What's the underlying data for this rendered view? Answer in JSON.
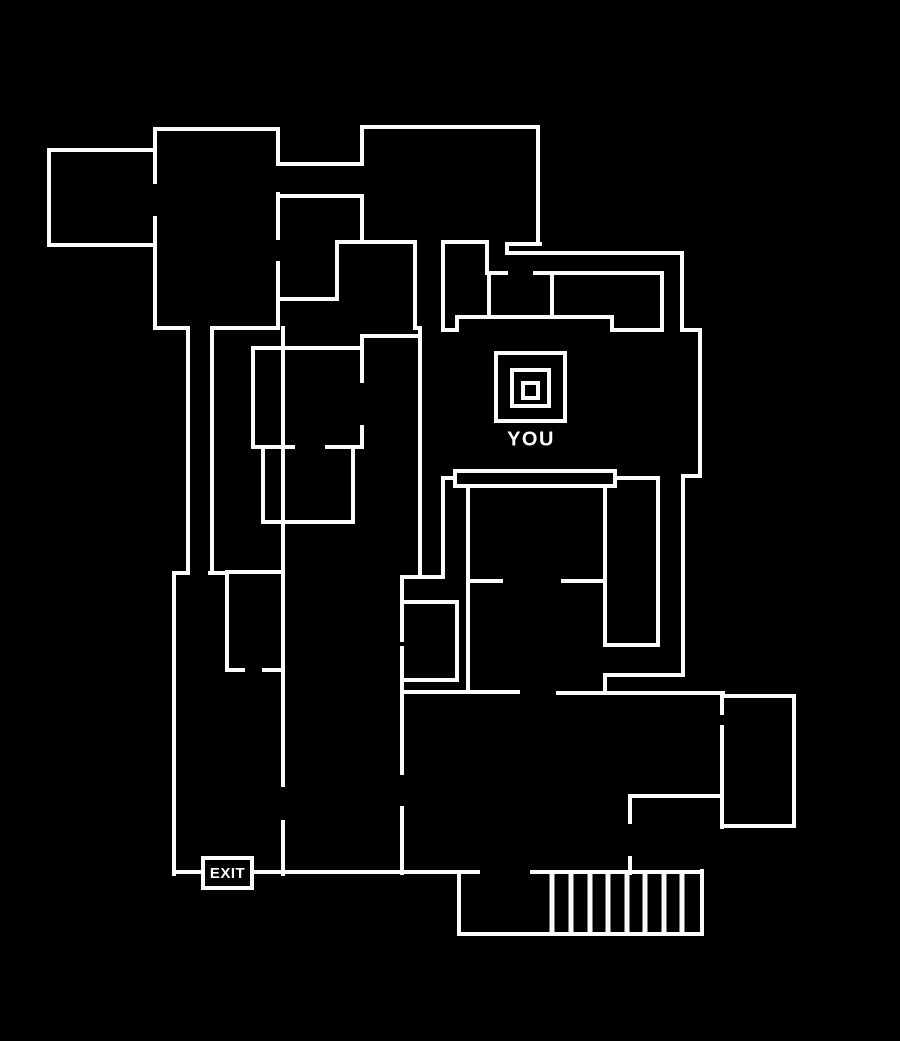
{
  "canvas": {
    "width": 900,
    "height": 1041,
    "background_color": "#000000",
    "wall_color": "#fbfbfb",
    "wall_width": 4
  },
  "you": {
    "label": "YOU"
  },
  "exit": {
    "label": "EXIT"
  },
  "map": {
    "walls": [
      [
        49,
        150,
        154,
        150
      ],
      [
        49,
        150,
        49,
        245
      ],
      [
        49,
        245,
        154,
        245
      ],
      [
        155,
        129,
        278,
        129
      ],
      [
        155,
        129,
        155,
        182
      ],
      [
        155,
        218,
        155,
        328
      ],
      [
        278,
        129,
        278,
        162
      ],
      [
        278,
        194,
        278,
        238
      ],
      [
        278,
        263,
        278,
        328
      ],
      [
        155,
        328,
        187,
        328
      ],
      [
        212,
        328,
        278,
        328
      ],
      [
        278,
        164,
        362,
        164
      ],
      [
        278,
        196,
        362,
        196
      ],
      [
        278,
        299,
        337,
        299
      ],
      [
        337,
        242,
        337,
        299
      ],
      [
        337,
        242,
        415,
        242
      ],
      [
        188,
        328,
        188,
        573
      ],
      [
        212,
        328,
        212,
        573
      ],
      [
        174,
        573,
        188,
        573
      ],
      [
        210,
        573,
        227,
        573
      ],
      [
        174,
        573,
        174,
        874
      ],
      [
        227,
        572,
        283,
        572
      ],
      [
        227,
        572,
        227,
        670
      ],
      [
        227,
        670,
        243,
        670
      ],
      [
        264,
        670,
        283,
        670
      ],
      [
        283,
        328,
        283,
        785
      ],
      [
        283,
        822,
        283,
        874
      ],
      [
        362,
        127,
        538,
        127
      ],
      [
        362,
        127,
        362,
        164
      ],
      [
        362,
        196,
        362,
        242
      ],
      [
        538,
        127,
        538,
        244
      ],
      [
        507,
        244,
        540,
        244
      ],
      [
        507,
        244,
        507,
        253
      ],
      [
        507,
        253,
        682,
        253
      ],
      [
        443,
        242,
        487,
        242
      ],
      [
        487,
        242,
        487,
        273
      ],
      [
        415,
        242,
        415,
        328
      ],
      [
        415,
        328,
        420,
        328
      ],
      [
        420,
        328,
        420,
        577
      ],
      [
        443,
        243,
        443,
        330
      ],
      [
        443,
        330,
        457,
        330
      ],
      [
        457,
        317,
        457,
        330
      ],
      [
        457,
        317,
        612,
        317
      ],
      [
        612,
        317,
        612,
        330
      ],
      [
        612,
        330,
        662,
        330
      ],
      [
        489,
        273,
        506,
        273
      ],
      [
        535,
        273,
        662,
        273
      ],
      [
        489,
        273,
        489,
        317
      ],
      [
        552,
        273,
        552,
        317
      ],
      [
        662,
        273,
        662,
        330
      ],
      [
        682,
        253,
        682,
        330
      ],
      [
        682,
        330,
        700,
        330
      ],
      [
        700,
        330,
        700,
        476
      ],
      [
        683,
        476,
        700,
        476
      ],
      [
        683,
        476,
        683,
        675
      ],
      [
        362,
        336,
        420,
        336
      ],
      [
        362,
        336,
        362,
        348
      ],
      [
        253,
        348,
        362,
        348
      ],
      [
        253,
        348,
        253,
        447
      ],
      [
        362,
        348,
        362,
        381
      ],
      [
        362,
        427,
        362,
        447
      ],
      [
        253,
        447,
        293,
        447
      ],
      [
        327,
        447,
        362,
        447
      ],
      [
        263,
        448,
        263,
        522
      ],
      [
        353,
        448,
        353,
        522
      ],
      [
        263,
        522,
        353,
        522
      ],
      [
        443,
        478,
        455,
        478
      ],
      [
        615,
        478,
        658,
        478
      ],
      [
        443,
        478,
        443,
        575
      ],
      [
        402,
        577,
        443,
        577
      ],
      [
        468,
        487,
        468,
        690
      ],
      [
        468,
        581,
        501,
        581
      ],
      [
        563,
        581,
        605,
        581
      ],
      [
        605,
        487,
        605,
        645
      ],
      [
        605,
        645,
        658,
        645
      ],
      [
        658,
        478,
        658,
        645
      ],
      [
        605,
        675,
        683,
        675
      ],
      [
        605,
        675,
        605,
        693
      ],
      [
        402,
        692,
        518,
        692
      ],
      [
        558,
        693,
        723,
        693
      ],
      [
        402,
        577,
        402,
        640
      ],
      [
        402,
        648,
        402,
        773
      ],
      [
        402,
        808,
        402,
        873
      ],
      [
        402,
        602,
        457,
        602
      ],
      [
        457,
        602,
        457,
        680
      ],
      [
        402,
        680,
        457,
        680
      ],
      [
        630,
        796,
        722,
        796
      ],
      [
        630,
        796,
        630,
        822
      ],
      [
        630,
        858,
        630,
        873
      ],
      [
        722,
        693,
        722,
        713
      ],
      [
        722,
        727,
        722,
        827
      ],
      [
        723,
        696,
        794,
        696
      ],
      [
        794,
        696,
        794,
        826
      ],
      [
        722,
        826,
        794,
        826
      ],
      [
        174,
        872,
        478,
        872
      ],
      [
        532,
        872,
        702,
        872
      ],
      [
        459,
        872,
        459,
        934
      ],
      [
        459,
        934,
        702,
        934
      ],
      [
        702,
        871,
        702,
        934
      ]
    ],
    "hatch": {
      "xs": [
        552,
        571,
        590,
        608,
        627,
        645,
        664,
        682
      ],
      "y1": 872,
      "y2": 934,
      "width": 5
    },
    "rects": [
      {
        "name": "stage-desk",
        "x": 455,
        "y": 471,
        "w": 160,
        "h": 15,
        "stroke": 4
      },
      {
        "name": "you-marker-outer-square",
        "x": 496,
        "y": 353,
        "w": 69,
        "h": 68,
        "stroke": 4
      },
      {
        "name": "you-marker-middle-square",
        "x": 512,
        "y": 370,
        "w": 37,
        "h": 36,
        "stroke": 4
      },
      {
        "name": "you-marker-inner-square",
        "x": 523,
        "y": 383,
        "w": 15,
        "h": 15,
        "stroke": 4
      }
    ]
  }
}
